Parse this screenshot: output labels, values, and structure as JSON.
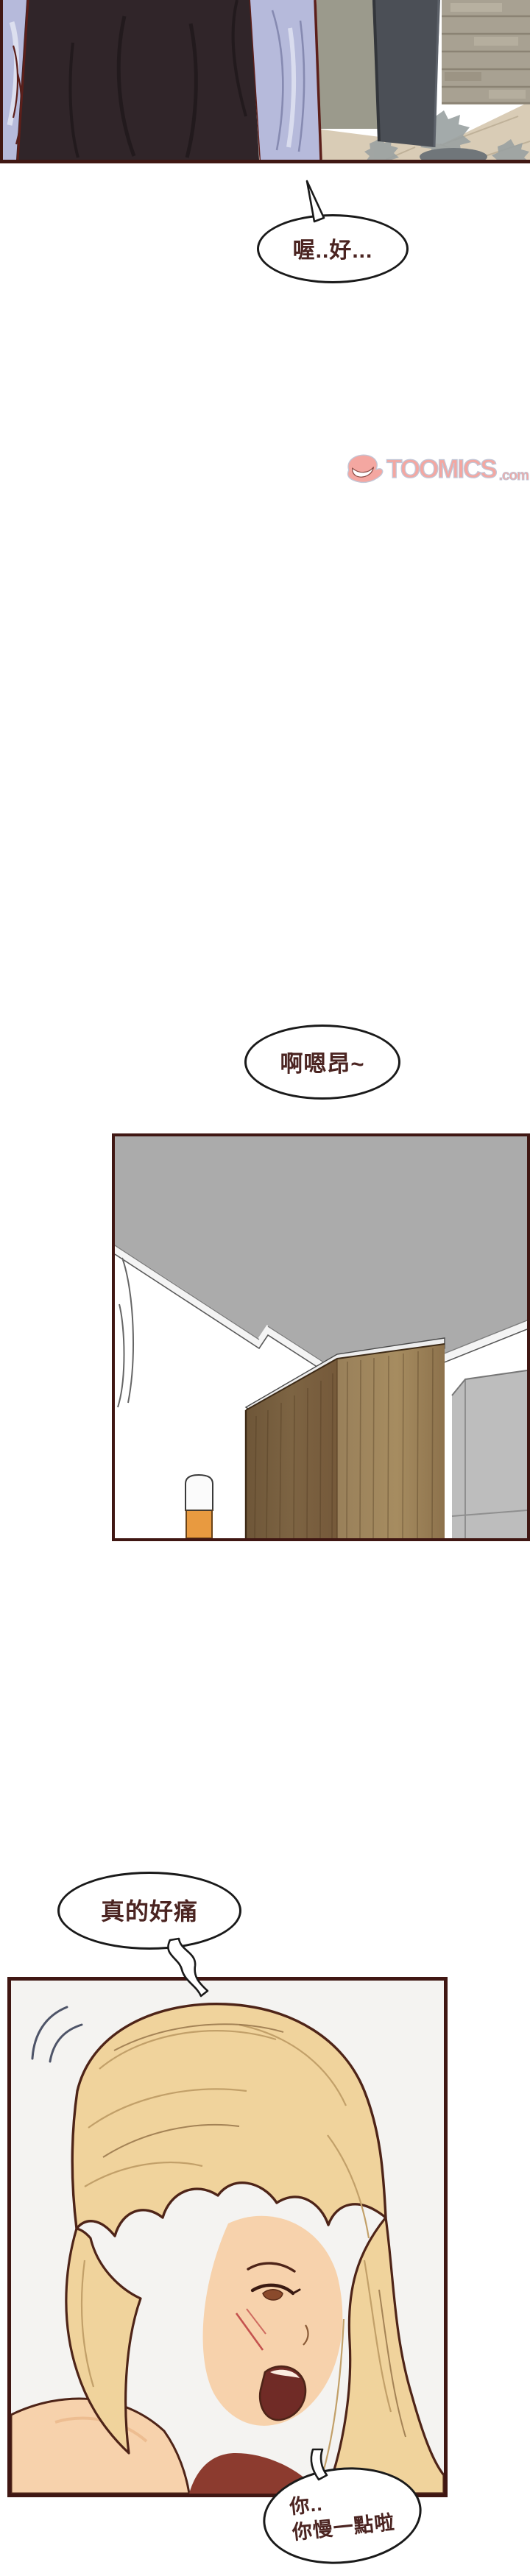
{
  "page": {
    "background": "#ffffff",
    "panel_border_color": "#401713",
    "bubble_outline_color": "#1a1a1a",
    "bubble_text_color": "#4b2421"
  },
  "watermark": {
    "brand": "TOOMICS",
    "suffix": ".com",
    "icon": "winking-eye-logo-icon",
    "pink": "#f4a7a1",
    "outline": "#c2c6d6"
  },
  "bubbles": {
    "b1": {
      "text": "喔..好..."
    },
    "b2": {
      "text": "啊嗯昂~"
    },
    "b3": {
      "text": "真的好痛"
    },
    "b4": {
      "line1": "你..",
      "line2": "你慢一點啦"
    }
  }
}
